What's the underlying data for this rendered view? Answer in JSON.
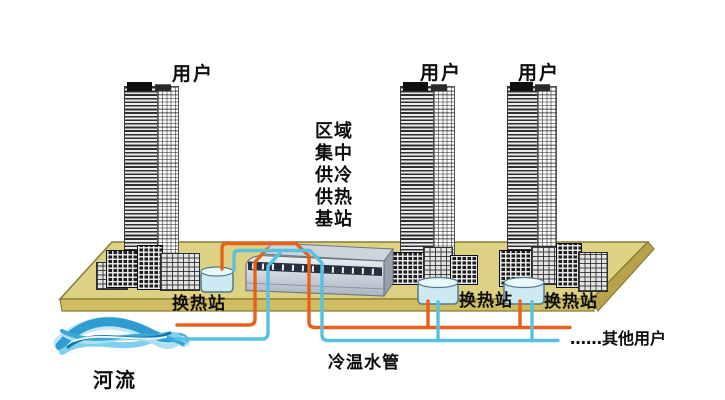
{
  "labels": {
    "users": [
      "用户",
      "用户",
      "用户"
    ],
    "station": [
      "区域",
      "集中",
      "供冷",
      "供热",
      "基站"
    ],
    "exchange_stations": [
      "换热站",
      "换热站",
      "换热站"
    ],
    "river": "河流",
    "pipes": "冷温水管",
    "other_users": "……其他用户"
  },
  "colors": {
    "hot_pipe": "#e8611c",
    "cold_pipe": "#57c1df",
    "platform_top": "#ddd183",
    "platform_front": "#cfbc63",
    "platform_side": "#b9a24c",
    "tank_fill": "#cdeaf3",
    "river_blue": "#2f9cd0"
  }
}
